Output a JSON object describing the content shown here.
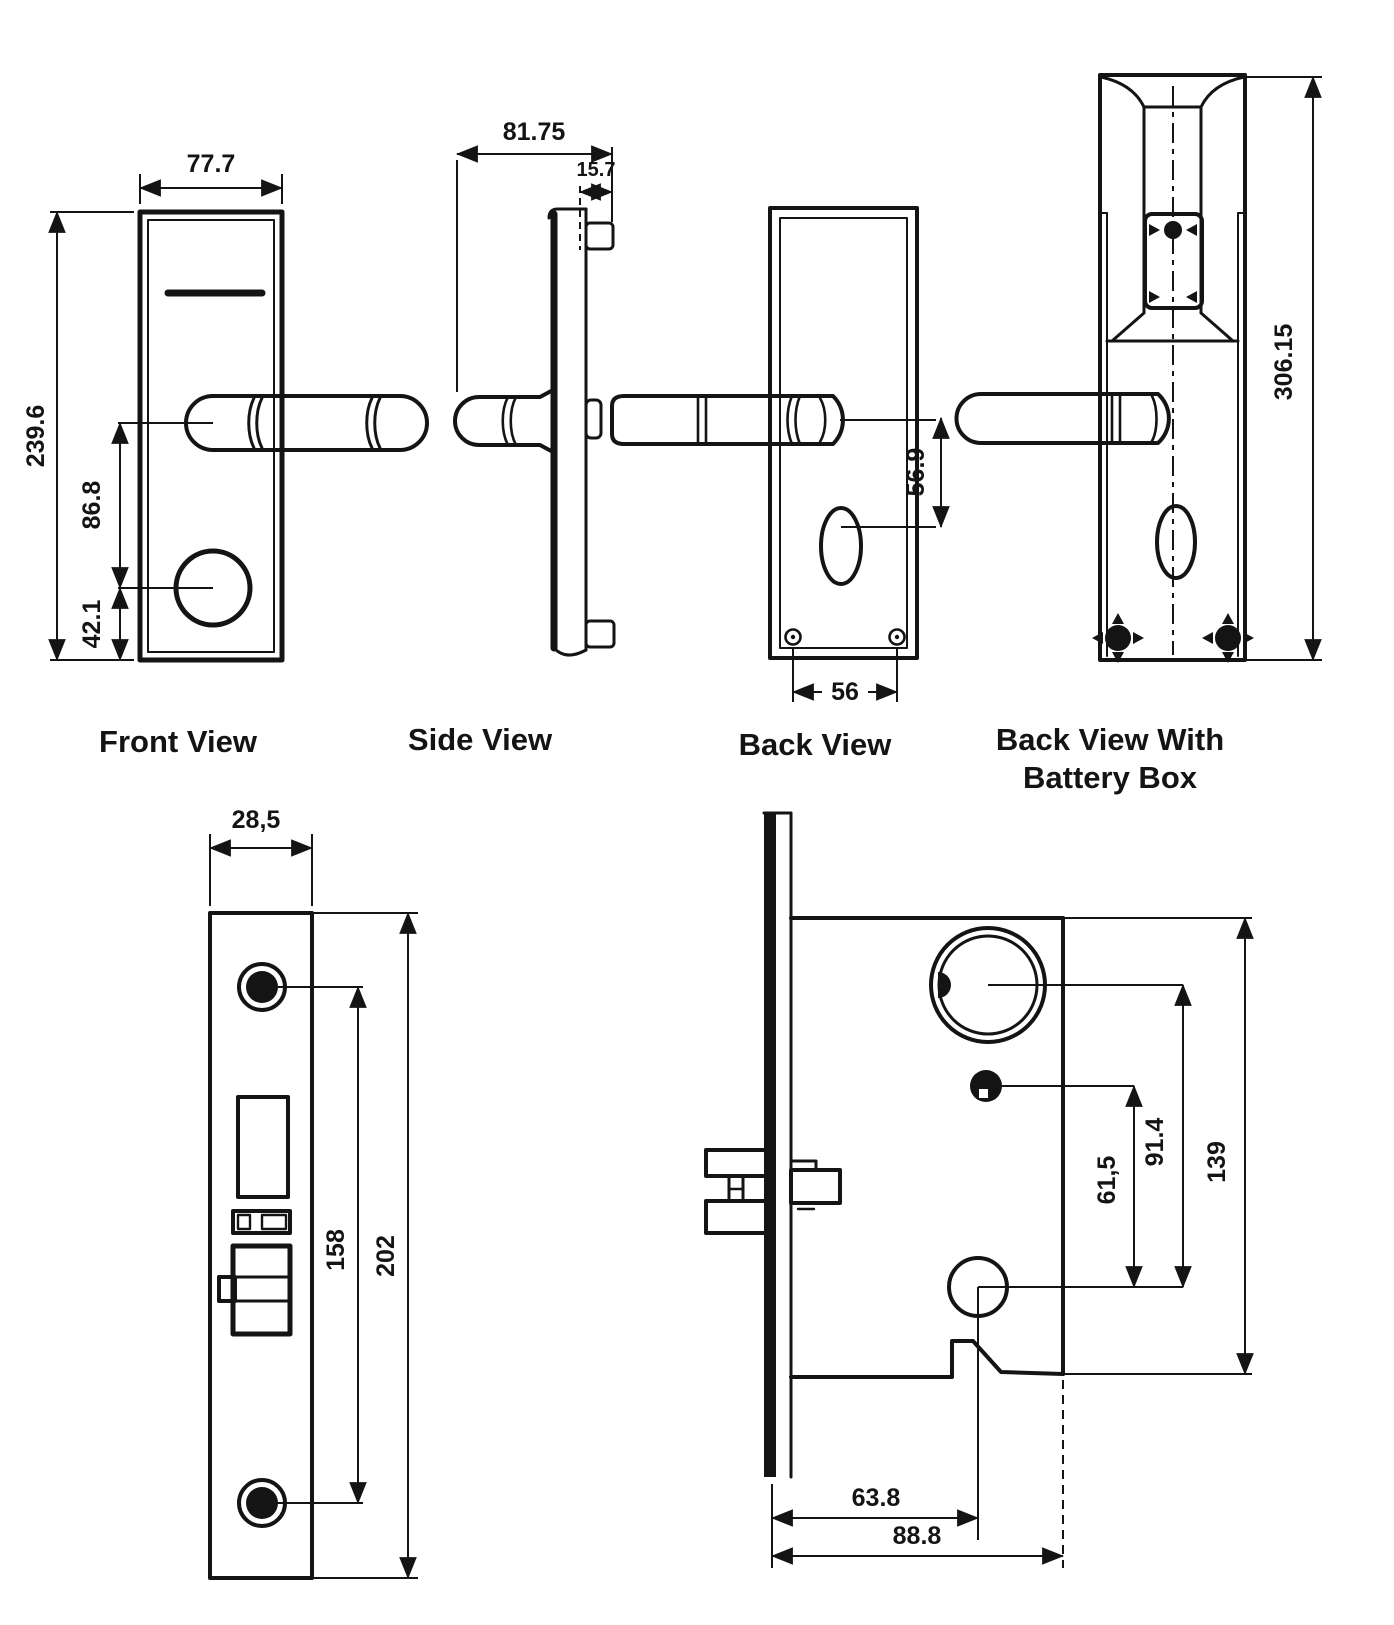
{
  "page": {
    "background": "#ffffff",
    "line_color": "#141414"
  },
  "views": {
    "front": {
      "label": "Front View",
      "dim_width": "77.7",
      "dim_height": "239.6",
      "dim_handle_to_knob": "86.8",
      "dim_knob_to_bottom": "42.1"
    },
    "side": {
      "label": "Side View",
      "dim_depth": "81.75",
      "dim_tab": "15.7"
    },
    "back": {
      "label": "Back View",
      "dim_handle_to_keyhole": "56.9",
      "dim_screw_span": "56"
    },
    "battery": {
      "label_line1": "Back View With",
      "label_line2": "Battery Box",
      "dim_height": "306.15"
    },
    "faceplate": {
      "dim_width": "28,5",
      "dim_screw_span": "158",
      "dim_height": "202"
    },
    "lockbody": {
      "dim_pin_to_bolt": "61,5",
      "dim_cyl_to_bolt": "91.4",
      "dim_case_height": "139",
      "dim_backset": "63.8",
      "dim_case_width": "88.8"
    }
  }
}
